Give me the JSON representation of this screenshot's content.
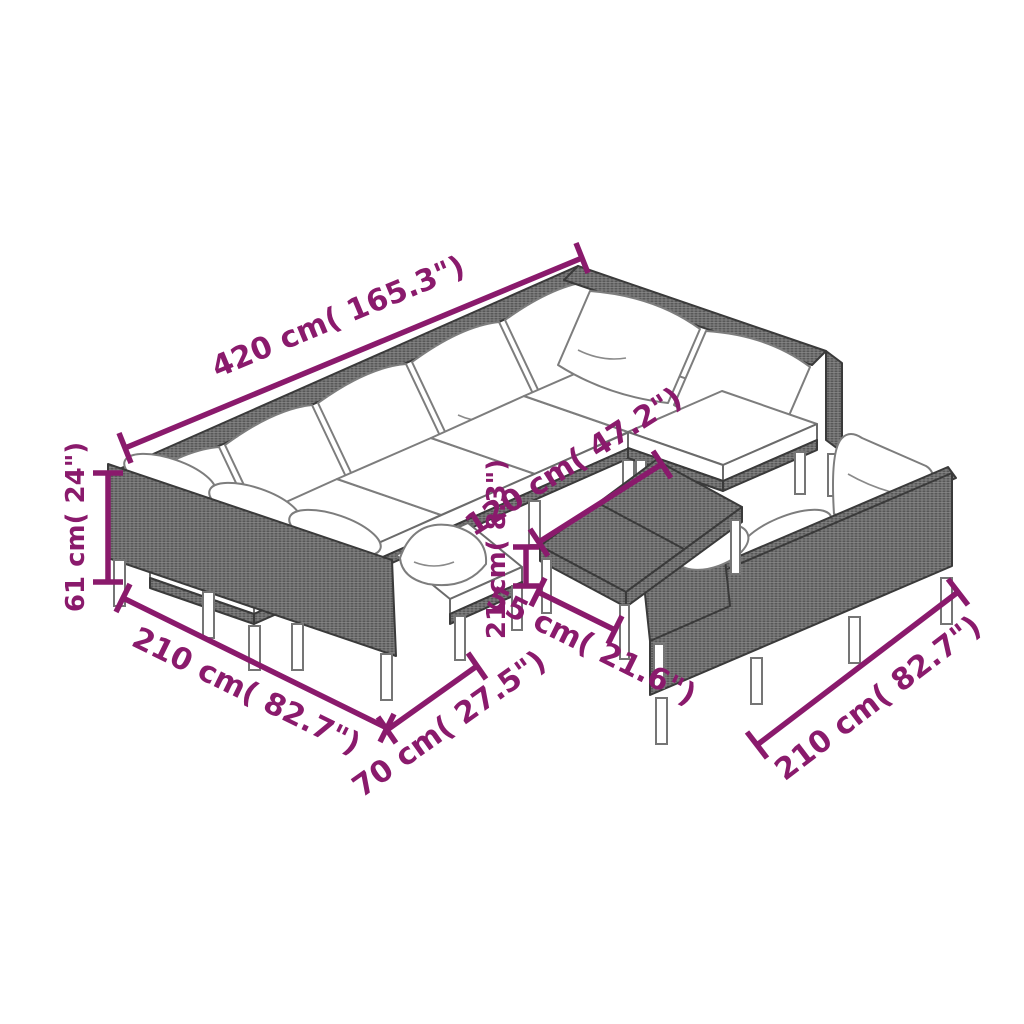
{
  "dims": {
    "top_length": "420 cm( 165.3\")",
    "backrest_height": "61 cm( 24\")",
    "left_length": "210 cm( 82.7\")",
    "seat_width": "70 cm( 27.5\")",
    "table_length": "120 cm( 47.2\")",
    "table_height": "21 cm( 8.3\")",
    "table_width": "55 cm( 21.6\")",
    "right_length": "210 cm( 82.7\")"
  },
  "colors": {
    "dimension_accent": "#8a1a6c",
    "rattan_gray": "#7b7b7b",
    "outline_gray": "#3a3a3a",
    "cushion_white": "#ffffff",
    "background": "#ffffff"
  }
}
